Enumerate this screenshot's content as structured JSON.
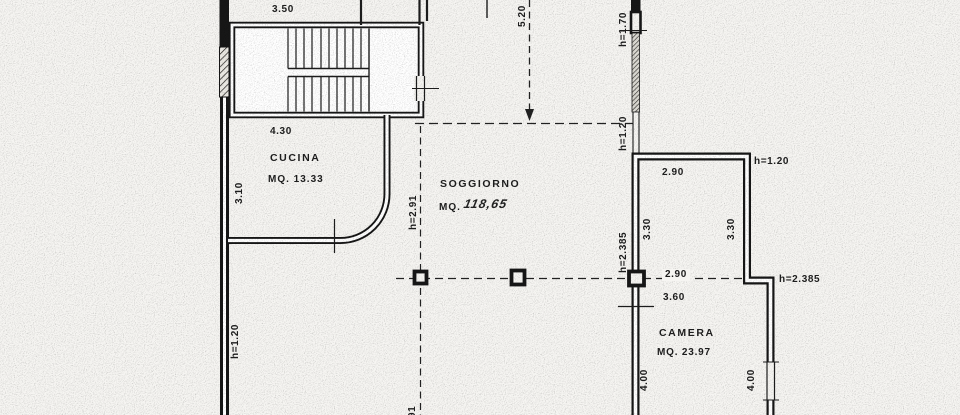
{
  "rooms": {
    "cucina": {
      "name": "CUCINA",
      "area": "MQ. 13.33"
    },
    "soggiorno": {
      "name": "SOGGIORNO",
      "area_prefix": "MQ.",
      "area_value": "118,65"
    },
    "camera": {
      "name": "CAMERA",
      "area": "MQ. 23.97"
    }
  },
  "dimensions": {
    "d350": "3.50",
    "d520": "5.20",
    "d430": "4.30",
    "d310": "3.10",
    "d290_top": "2.90",
    "d330_left": "3.30",
    "d330_right": "3.30",
    "d290_bottom": "2.90",
    "d360": "3.60",
    "d400_left": "4.00",
    "d400_right": "4.00",
    "partial_bottom": "91"
  },
  "heights": {
    "h170": "h=1.70",
    "h120_left": "h=1.20",
    "h291": "h=2.91",
    "h120_parapet": "h=1.20",
    "h120_right": "h=1.20",
    "h2385_wall": "h=2.385",
    "h2385_right": "h=2.385"
  },
  "colors": {
    "ink": "#1d1d1d",
    "paper": "#f6f5f2"
  }
}
